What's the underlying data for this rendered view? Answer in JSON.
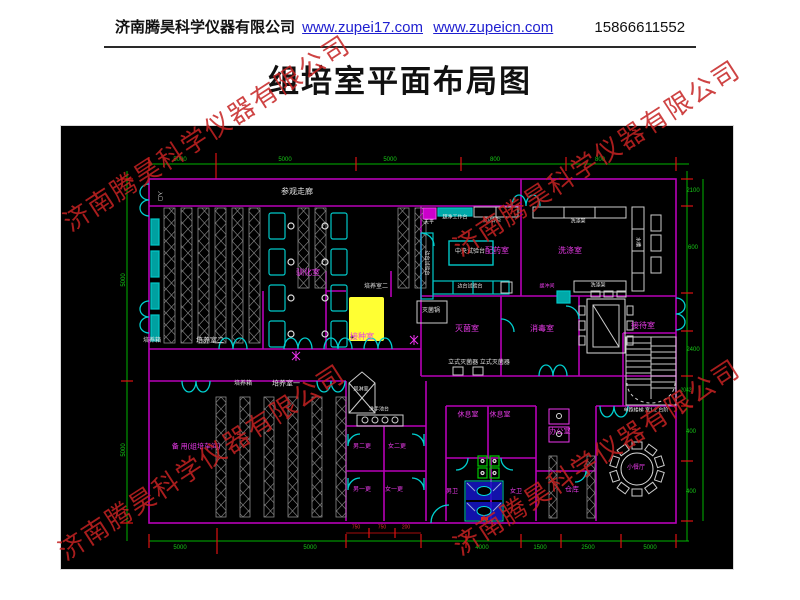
{
  "header": {
    "company": "济南腾昊科学仪器有限公司",
    "url1": "www.zupei17.com",
    "url2": "www.zupeicn.com",
    "phone": "15866611552"
  },
  "title": "组培室平面布局图",
  "watermark": {
    "text": "济南腾昊科学仪器有限公司",
    "color": "#c62222"
  },
  "plan": {
    "background": "#000000",
    "colors": {
      "wall": "#b800b8",
      "dimension": "#00b400",
      "tick": "#dd1111",
      "fixture": "#00c8c8",
      "rack": "#8a8a8a",
      "room_label": "#e93ae9",
      "equipment_label": "#e4e4e4",
      "highlight": "#ffff33",
      "stall": "#1515c8",
      "squat": "#00bb00"
    },
    "labels": [
      {
        "t": "参观走廊",
        "x": 297,
        "y": 192,
        "c": "w",
        "s": 8
      },
      {
        "t": "入口",
        "x": 159,
        "y": 196,
        "c": "w",
        "s": 5,
        "r": 90
      },
      {
        "t": "培养箱",
        "x": 152,
        "y": 341,
        "c": "w",
        "s": 6
      },
      {
        "t": "培养室二",
        "x": 210,
        "y": 341,
        "c": "w",
        "s": 7
      },
      {
        "t": "培养室二",
        "x": 376,
        "y": 287,
        "c": "w",
        "s": 6
      },
      {
        "t": "驯化室",
        "x": 308,
        "y": 273,
        "c": "m",
        "s": 8
      },
      {
        "t": "接种室",
        "x": 362,
        "y": 337,
        "c": "m",
        "s": 8
      },
      {
        "t": "配药室",
        "x": 497,
        "y": 251,
        "c": "m",
        "s": 8
      },
      {
        "t": "洗涤室",
        "x": 570,
        "y": 251,
        "c": "m",
        "s": 8
      },
      {
        "t": "灭菌室",
        "x": 467,
        "y": 329,
        "c": "m",
        "s": 8
      },
      {
        "t": "消毒室",
        "x": 542,
        "y": 329,
        "c": "m",
        "s": 8
      },
      {
        "t": "接待室",
        "x": 643,
        "y": 326,
        "c": "m",
        "s": 8
      },
      {
        "t": "缓冲间",
        "x": 547,
        "y": 287,
        "c": "m",
        "s": 5
      },
      {
        "t": "药品柜",
        "x": 492,
        "y": 221,
        "c": "w",
        "s": 6
      },
      {
        "t": "天平",
        "x": 429,
        "y": 223,
        "c": "w",
        "s": 5
      },
      {
        "t": "超净工作台",
        "x": 455,
        "y": 218,
        "c": "w",
        "s": 5
      },
      {
        "t": "中央试验台",
        "x": 470,
        "y": 252,
        "c": "w",
        "s": 6
      },
      {
        "t": "边台试验台",
        "x": 426,
        "y": 263,
        "c": "w",
        "s": 5,
        "r": 90
      },
      {
        "t": "边台试验台",
        "x": 470,
        "y": 287,
        "c": "w",
        "s": 5
      },
      {
        "t": "灭菌锅",
        "x": 431,
        "y": 311,
        "c": "w",
        "s": 6
      },
      {
        "t": "洗涤架",
        "x": 578,
        "y": 222,
        "c": "w",
        "s": 5
      },
      {
        "t": "洗涤架",
        "x": 598,
        "y": 286,
        "c": "w",
        "s": 5
      },
      {
        "t": "水槽",
        "x": 637,
        "y": 242,
        "c": "w",
        "s": 5,
        "r": 90
      },
      {
        "t": "立式灭菌器 立式灭菌器",
        "x": 479,
        "y": 363,
        "c": "w",
        "s": 6
      },
      {
        "t": "风淋室",
        "x": 361,
        "y": 390,
        "c": "w",
        "s": 5
      },
      {
        "t": "洗手池台",
        "x": 379,
        "y": 410,
        "c": "w",
        "s": 5
      },
      {
        "t": "培养箱",
        "x": 243,
        "y": 384,
        "c": "w",
        "s": 6
      },
      {
        "t": "培养室一",
        "x": 286,
        "y": 384,
        "c": "w",
        "s": 7
      },
      {
        "t": "备 用(组培车间)",
        "x": 196,
        "y": 447,
        "c": "m",
        "s": 7
      },
      {
        "t": "休息室",
        "x": 468,
        "y": 415,
        "c": "m",
        "s": 7
      },
      {
        "t": "休息室",
        "x": 500,
        "y": 415,
        "c": "m",
        "s": 7
      },
      {
        "t": "办公室",
        "x": 560,
        "y": 432,
        "c": "m",
        "s": 7
      },
      {
        "t": "男二更",
        "x": 362,
        "y": 447,
        "c": "m",
        "s": 6
      },
      {
        "t": "女二更",
        "x": 397,
        "y": 447,
        "c": "m",
        "s": 6
      },
      {
        "t": "男一更",
        "x": 362,
        "y": 490,
        "c": "m",
        "s": 6
      },
      {
        "t": "女一更",
        "x": 394,
        "y": 490,
        "c": "m",
        "s": 6
      },
      {
        "t": "男卫",
        "x": 452,
        "y": 492,
        "c": "m",
        "s": 6
      },
      {
        "t": "女卫",
        "x": 516,
        "y": 492,
        "c": "m",
        "s": 6
      },
      {
        "t": "仓库",
        "x": 572,
        "y": 490,
        "c": "m",
        "s": 7
      },
      {
        "t": "小餐厅",
        "x": 636,
        "y": 468,
        "c": "m",
        "s": 6
      },
      {
        "t": "单跑楼梯 宽1.2 台阶",
        "x": 646,
        "y": 411,
        "c": "w",
        "s": 5
      },
      {
        "t": "5000",
        "x": 180,
        "y": 160,
        "c": "g",
        "s": 6
      },
      {
        "t": "5000",
        "x": 285,
        "y": 160,
        "c": "g",
        "s": 6
      },
      {
        "t": "5000",
        "x": 390,
        "y": 160,
        "c": "g",
        "s": 6
      },
      {
        "t": "800",
        "x": 495,
        "y": 160,
        "c": "g",
        "s": 6
      },
      {
        "t": "800",
        "x": 600,
        "y": 160,
        "c": "g",
        "s": 6
      },
      {
        "t": "5000",
        "x": 124,
        "y": 280,
        "c": "g",
        "s": 6,
        "r": -90
      },
      {
        "t": "5000",
        "x": 124,
        "y": 450,
        "c": "g",
        "s": 6,
        "r": -90
      },
      {
        "t": "2100",
        "x": 693,
        "y": 191,
        "c": "g",
        "s": 6
      },
      {
        "t": "600",
        "x": 693,
        "y": 248,
        "c": "g",
        "s": 6
      },
      {
        "t": "2400",
        "x": 693,
        "y": 350,
        "c": "g",
        "s": 6
      },
      {
        "t": "2042",
        "x": 686,
        "y": 391,
        "c": "g",
        "s": 5
      },
      {
        "t": "400",
        "x": 691,
        "y": 432,
        "c": "g",
        "s": 6
      },
      {
        "t": "400",
        "x": 691,
        "y": 492,
        "c": "g",
        "s": 6
      },
      {
        "t": "5000",
        "x": 180,
        "y": 548,
        "c": "g",
        "s": 6
      },
      {
        "t": "5000",
        "x": 310,
        "y": 548,
        "c": "g",
        "s": 6
      },
      {
        "t": "4000",
        "x": 482,
        "y": 548,
        "c": "g",
        "s": 6
      },
      {
        "t": "1500",
        "x": 540,
        "y": 548,
        "c": "g",
        "s": 6
      },
      {
        "t": "2500",
        "x": 588,
        "y": 548,
        "c": "g",
        "s": 6
      },
      {
        "t": "5000",
        "x": 650,
        "y": 548,
        "c": "g",
        "s": 6
      },
      {
        "t": "750",
        "x": 356,
        "y": 528,
        "c": "r",
        "s": 5
      },
      {
        "t": "750",
        "x": 382,
        "y": 528,
        "c": "r",
        "s": 5
      },
      {
        "t": "200",
        "x": 406,
        "y": 528,
        "c": "r",
        "s": 5
      }
    ]
  }
}
